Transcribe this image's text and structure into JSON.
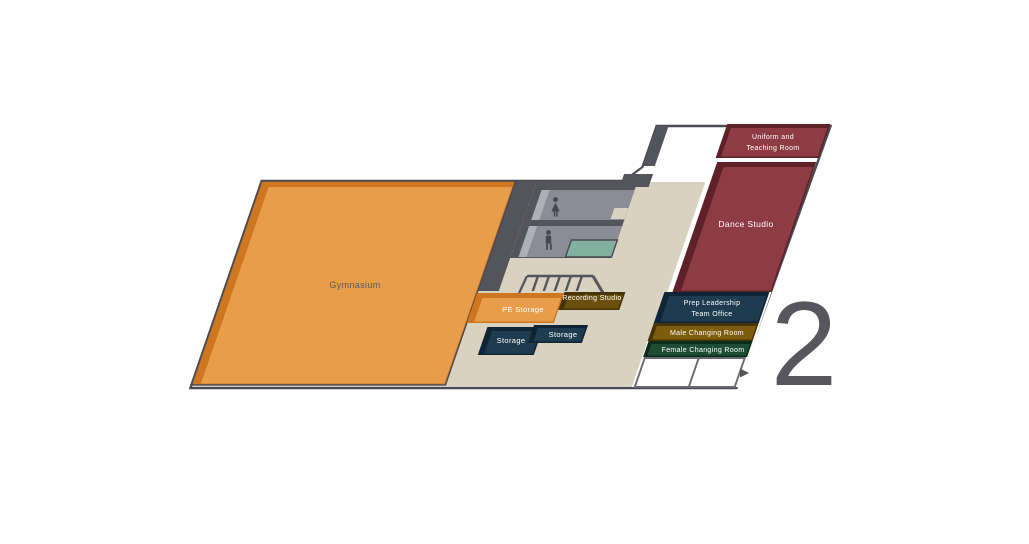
{
  "floor": {
    "number": "2"
  },
  "palette": {
    "wall": "#54545C",
    "outline": "#4A4A52",
    "corridor_floor": "#DAD2C0",
    "toilet_gray": "#8C8C96",
    "toilet_light": "#AFAFB7",
    "washroom_teal": "#82B09E",
    "icon_gray": "#46464E",
    "room_outline_thin": "#6A6A70",
    "number_color": "#56565C",
    "white": "#FFFFFF"
  },
  "icons": {
    "female_toilet": "female-person-icon",
    "male_toilet": "male-person-icon",
    "stairs": "stairs-icon",
    "entrance_arrow": "direction-arrow-icon"
  },
  "rooms": [
    {
      "id": "gymnasium",
      "label_lines": [
        "Gymnasium"
      ],
      "fill": "#E79D4A",
      "border": "#CE7620",
      "text": "#5B5B63",
      "size": 9,
      "rect": [
        324,
        181,
        254,
        204
      ],
      "bevel": [
        9,
        6
      ],
      "label": [
        355,
        288
      ],
      "outline": true
    },
    {
      "id": "pe-storage",
      "label_lines": [
        "PE Storage"
      ],
      "fill": "#E79D4A",
      "border": "#CE7620",
      "text": "#FFFFFF",
      "size": 7.5,
      "rect": [
        578,
        293,
        87,
        30
      ],
      "bevel": [
        7,
        5
      ],
      "label": [
        523,
        312
      ]
    },
    {
      "id": "recording-studio",
      "label_lines": [
        "Recording Studio"
      ],
      "fill": "#6B4F0E",
      "border": "#463306",
      "text": "#FFFFFF",
      "size": 7,
      "rect": [
        665,
        292,
        61,
        18
      ],
      "bevel": [
        5,
        3
      ],
      "label": [
        592,
        300
      ]
    },
    {
      "id": "storage-west",
      "label_lines": [
        "Storage"
      ],
      "fill": "#1F3B4F",
      "border": "#0F2434",
      "text": "#FFFFFF",
      "size": 7.5,
      "rect": [
        600,
        327,
        56,
        28
      ],
      "bevel": [
        6,
        4
      ],
      "label": [
        511,
        343
      ]
    },
    {
      "id": "storage-east",
      "label_lines": [
        "Storage"
      ],
      "fill": "#1F3B4F",
      "border": "#0F2434",
      "text": "#FFFFFF",
      "size": 7.5,
      "rect": [
        646,
        325,
        54,
        18
      ],
      "bevel": [
        5,
        3
      ],
      "label": [
        563,
        337
      ]
    },
    {
      "id": "uniform-and-teaching-room",
      "label_lines": [
        "Uniform and",
        "Teaching Room"
      ],
      "fill": "#8E3C43",
      "border": "#5E2127",
      "text": "#FFFFFF",
      "size": 7,
      "rect": [
        770,
        124,
        103,
        34
      ],
      "bevel": [
        5,
        4
      ],
      "label": [
        773,
        139
      ]
    },
    {
      "id": "dance-studio",
      "label_lines": [
        "Dance Studio"
      ],
      "fill": "#8E3C43",
      "border": "#5E2127",
      "text": "#FFFFFF",
      "size": 8.5,
      "rect": [
        773,
        162,
        99,
        130
      ],
      "bevel": [
        8,
        5
      ],
      "label": [
        746,
        227
      ]
    },
    {
      "id": "prep-leadership-team-office",
      "label_lines": [
        "Prep Leadership",
        "Team Office"
      ],
      "fill": "#1F3B4F",
      "border": "#0F2434",
      "text": "#FFFFFF",
      "size": 7,
      "rect": [
        765,
        292,
        105,
        31
      ],
      "bevel": [
        6,
        4
      ],
      "label": [
        712,
        305
      ]
    },
    {
      "id": "male-changing-room",
      "label_lines": [
        "Male Changing Room"
      ],
      "fill": "#7D5C0B",
      "border": "#463306",
      "text": "#FFFFFF",
      "size": 7,
      "rect": [
        765,
        323,
        105,
        18
      ],
      "bevel": [
        4,
        3
      ],
      "label": [
        707,
        335
      ]
    },
    {
      "id": "female-changing-room",
      "label_lines": [
        "Female Changing Room"
      ],
      "fill": "#1F4D33",
      "border": "#0D2C1B",
      "text": "#FFFFFF",
      "size": 7,
      "rect": [
        766,
        341,
        104,
        16
      ],
      "bevel": [
        4,
        3
      ],
      "label": [
        703,
        352
      ]
    }
  ]
}
